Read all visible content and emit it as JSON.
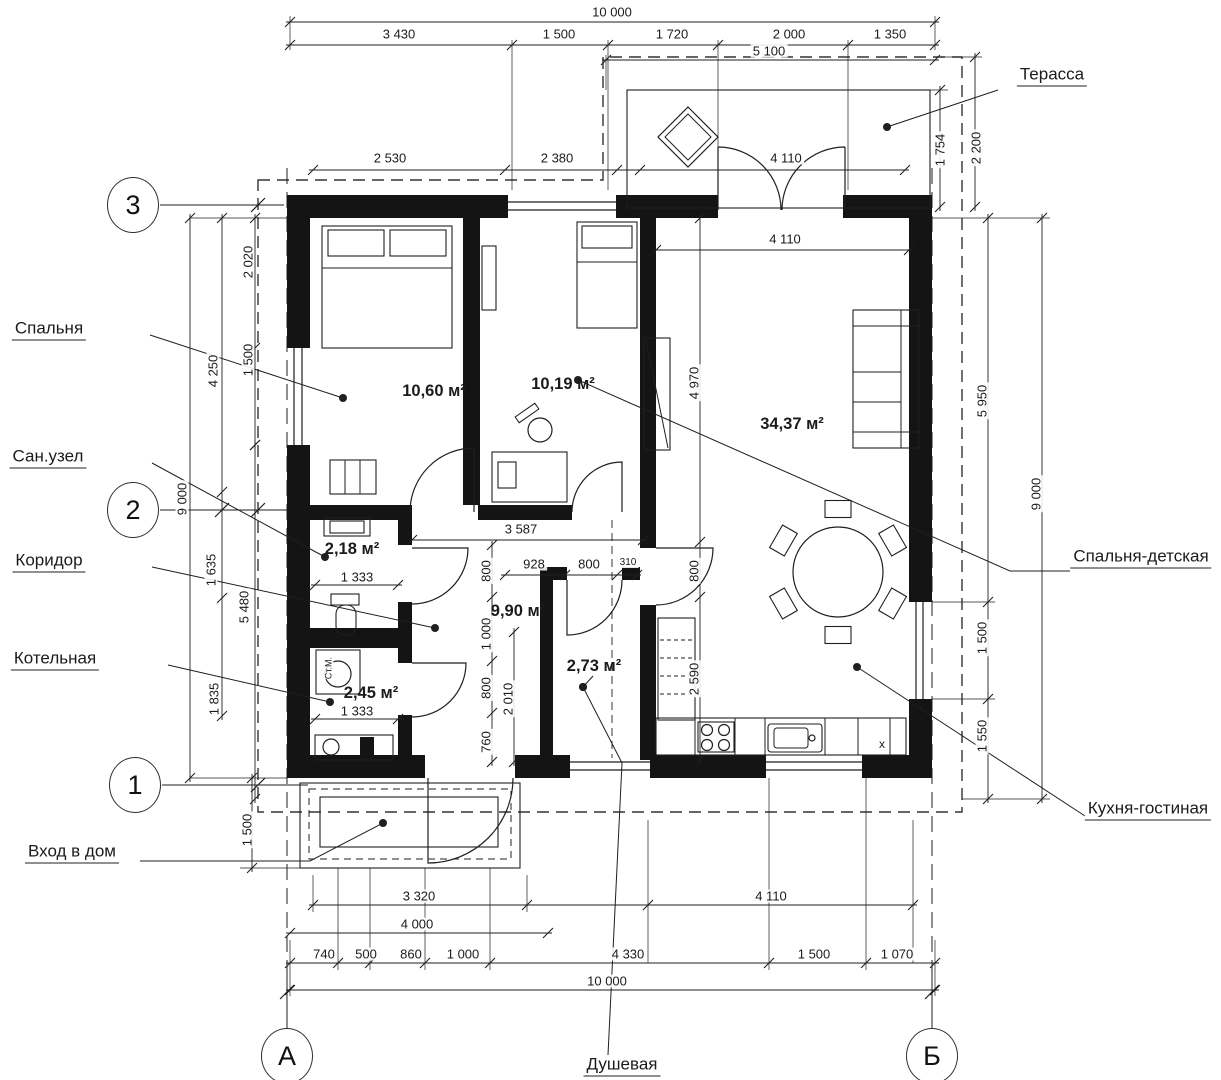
{
  "plan": {
    "language": "ru",
    "rooms": [
      {
        "name": "room-area-bedroom",
        "area": "10,60 м²",
        "x": 434,
        "y": 391
      },
      {
        "name": "room-area-bedroom-kids",
        "area": "10,19 м²",
        "x": 563,
        "y": 384
      },
      {
        "name": "room-area-kitchen-living",
        "area": "34,37 м²",
        "x": 792,
        "y": 424
      },
      {
        "name": "room-area-san-uzel",
        "area": "2,18 м²",
        "x": 352,
        "y": 549
      },
      {
        "name": "room-area-corridor",
        "area": "9,90 м²",
        "x": 518,
        "y": 611
      },
      {
        "name": "room-area-shower",
        "area": "2,73 м²",
        "x": 594,
        "y": 666
      },
      {
        "name": "room-area-boiler",
        "area": "2,45 м²",
        "x": 371,
        "y": 693
      }
    ],
    "callout_labels": [
      {
        "name": "label-bedroom",
        "text": "Спальня",
        "x": 49,
        "y": 330
      },
      {
        "name": "label-san-uzel",
        "text": "Сан.узел",
        "x": 48,
        "y": 458
      },
      {
        "name": "label-corridor",
        "text": "Коридор",
        "x": 49,
        "y": 562
      },
      {
        "name": "label-boiler-room",
        "text": "Котельная",
        "x": 55,
        "y": 660
      },
      {
        "name": "label-entrance",
        "text": "Вход в дом",
        "x": 72,
        "y": 853
      },
      {
        "name": "label-terrace",
        "text": "Терасса",
        "x": 1052,
        "y": 76
      },
      {
        "name": "label-bedroom-kids",
        "text": "Спальня-детская",
        "x": 1141,
        "y": 558
      },
      {
        "name": "label-kitchen-living",
        "text": "Кухня-гостиная",
        "x": 1148,
        "y": 810
      },
      {
        "name": "label-shower",
        "text": "Душевая",
        "x": 622,
        "y": 1066
      }
    ],
    "axis_markers": [
      {
        "name": "axis-3",
        "label": "3",
        "x": 133,
        "y": 205
      },
      {
        "name": "axis-2",
        "label": "2",
        "x": 133,
        "y": 510
      },
      {
        "name": "axis-1",
        "label": "1",
        "x": 135,
        "y": 785
      },
      {
        "name": "axis-a",
        "label": "А",
        "x": 287,
        "y": 1056
      },
      {
        "name": "axis-b",
        "label": "Б",
        "x": 932,
        "y": 1056
      }
    ],
    "dimension_labels": [
      {
        "text": "10 000",
        "x": 612,
        "y": 12
      },
      {
        "text": "3 430",
        "x": 399,
        "y": 34
      },
      {
        "text": "1 500",
        "x": 559,
        "y": 34
      },
      {
        "text": "1 720",
        "x": 672,
        "y": 34
      },
      {
        "text": "2 000",
        "x": 789,
        "y": 34
      },
      {
        "text": "1 350",
        "x": 890,
        "y": 34
      },
      {
        "text": "5 100",
        "x": 769,
        "y": 51
      },
      {
        "text": "2 530",
        "x": 390,
        "y": 158
      },
      {
        "text": "2 380",
        "x": 557,
        "y": 158
      },
      {
        "text": "4 110",
        "x": 786,
        "y": 158
      },
      {
        "text": "4 110",
        "x": 785,
        "y": 239
      },
      {
        "text": "1 754",
        "x": 940,
        "y": 150,
        "rot": true
      },
      {
        "text": "2 200",
        "x": 976,
        "y": 148,
        "rot": true
      },
      {
        "text": "2 020",
        "x": 248,
        "y": 262,
        "rot": true
      },
      {
        "text": "4 250",
        "x": 213,
        "y": 371,
        "rot": true
      },
      {
        "text": "1 500",
        "x": 248,
        "y": 360,
        "rot": true
      },
      {
        "text": "9 000",
        "x": 182,
        "y": 499,
        "rot": true
      },
      {
        "text": "1 635",
        "x": 211,
        "y": 570,
        "rot": true
      },
      {
        "text": "5 480",
        "x": 244,
        "y": 607,
        "rot": true
      },
      {
        "text": "1 835",
        "x": 214,
        "y": 699,
        "rot": true
      },
      {
        "text": "1 500",
        "x": 247,
        "y": 830,
        "rot": true
      },
      {
        "text": "5 950",
        "x": 982,
        "y": 401,
        "rot": true
      },
      {
        "text": "9 000",
        "x": 1036,
        "y": 494,
        "rot": true
      },
      {
        "text": "1 500",
        "x": 982,
        "y": 638,
        "rot": true
      },
      {
        "text": "1 550",
        "x": 982,
        "y": 736,
        "rot": true
      },
      {
        "text": "4 970",
        "x": 694,
        "y": 383,
        "rot": true
      },
      {
        "text": "800",
        "x": 486,
        "y": 571,
        "rot": true
      },
      {
        "text": "1 000",
        "x": 486,
        "y": 634,
        "rot": true
      },
      {
        "text": "800",
        "x": 486,
        "y": 688,
        "rot": true
      },
      {
        "text": "760",
        "x": 486,
        "y": 742,
        "rot": true
      },
      {
        "text": "2 010",
        "x": 508,
        "y": 699,
        "rot": true
      },
      {
        "text": "800",
        "x": 694,
        "y": 571,
        "rot": true
      },
      {
        "text": "2 590",
        "x": 694,
        "y": 679,
        "rot": true
      },
      {
        "text": "3 587",
        "x": 521,
        "y": 529
      },
      {
        "text": "928",
        "x": 534,
        "y": 564
      },
      {
        "text": "800",
        "x": 589,
        "y": 564
      },
      {
        "text": "310",
        "x": 628,
        "y": 563,
        "fs": 10
      },
      {
        "text": "1 333",
        "x": 357,
        "y": 577
      },
      {
        "text": "1 333",
        "x": 357,
        "y": 711
      },
      {
        "text": "3 320",
        "x": 419,
        "y": 896
      },
      {
        "text": "4 110",
        "x": 771,
        "y": 896
      },
      {
        "text": "4 000",
        "x": 417,
        "y": 924
      },
      {
        "text": "740",
        "x": 324,
        "y": 954
      },
      {
        "text": "500",
        "x": 366,
        "y": 954
      },
      {
        "text": "860",
        "x": 411,
        "y": 954
      },
      {
        "text": "1 000",
        "x": 463,
        "y": 954
      },
      {
        "text": "4 330",
        "x": 628,
        "y": 954
      },
      {
        "text": "1 500",
        "x": 814,
        "y": 954
      },
      {
        "text": "1 070",
        "x": 897,
        "y": 954
      },
      {
        "text": "10 000",
        "x": 607,
        "y": 981
      }
    ],
    "annotations": [
      {
        "name": "washing-machine-label",
        "text": "Ст.М.",
        "x": 329,
        "y": 668,
        "rot": true,
        "fs": 9
      },
      {
        "name": "cooker-hood-symbol",
        "text": "x",
        "x": 882,
        "y": 744,
        "fs": 12
      }
    ]
  },
  "colors": {
    "background": "#ffffff",
    "line": "#1f1f1f",
    "wall": "#141414"
  }
}
